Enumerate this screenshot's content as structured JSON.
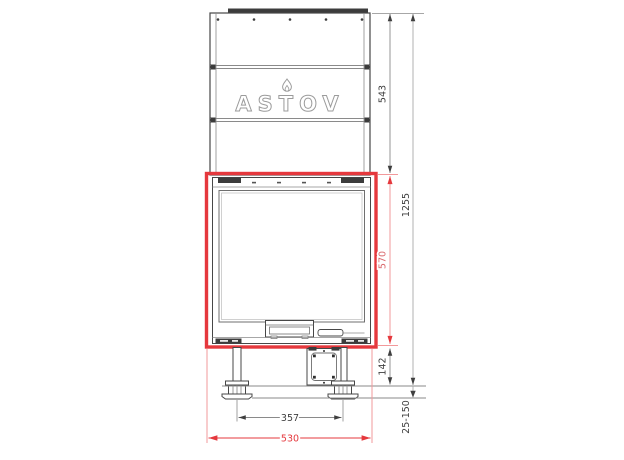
{
  "drawing": {
    "brand": "ASTOV",
    "dims": {
      "upper_section_height": "543",
      "total_height": "1255",
      "opening_height": "570",
      "base_height": "142",
      "feet_spacing": "357",
      "overall_width": "530",
      "foot_adjust_range": "25-150"
    },
    "colors": {
      "highlight_red": "#e5383d",
      "dim_red_light": "#f2999b",
      "line_dark": "#474747",
      "dim_gray": "#8a8a8a"
    }
  }
}
